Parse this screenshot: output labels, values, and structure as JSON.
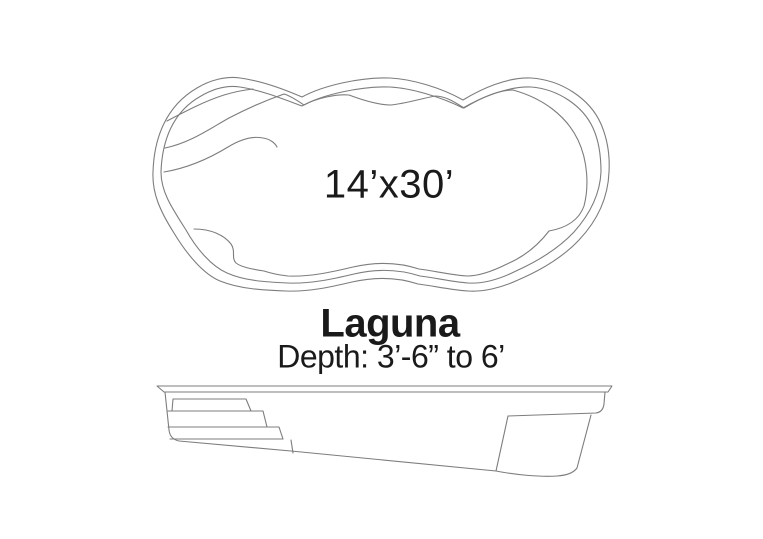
{
  "pool": {
    "model": "Laguna",
    "size": "14’x30’",
    "depth": "Depth: 3’-6” to 6’"
  },
  "colors": {
    "line": "#7d7d7d",
    "text": "#1a1a1a",
    "background": "#ffffff"
  }
}
